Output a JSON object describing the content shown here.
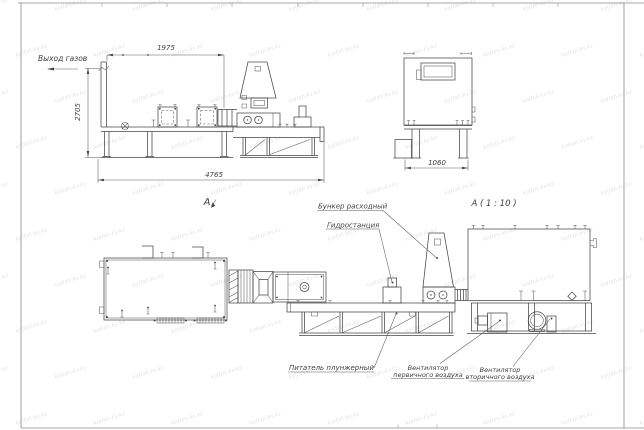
{
  "sheet": {
    "background": "#ffffff",
    "line_color": "#474747",
    "watermark_text": "kotlah-kv.kz",
    "watermark_color": "#c9ccd4"
  },
  "front_view": {
    "gas_outlet_label": "Выход газов",
    "dim_top": "1975",
    "dim_left": "2705",
    "dim_bottom": "4765",
    "view_arrow_label": "А"
  },
  "side_view": {
    "dim_bottom": "1060"
  },
  "detail_view": {
    "title": "А ( 1 : 10 )"
  },
  "callouts": {
    "hopper": "Бункер расходный",
    "hydro_station": "Гидростанция",
    "plunger_feeder": "Питатель плунжерный",
    "primary_fan_line1": "Вентилятор",
    "primary_fan_line2": "первичного воздуха",
    "secondary_fan_line1": "Вентилятор",
    "secondary_fan_line2": "вторичного воздуха"
  }
}
